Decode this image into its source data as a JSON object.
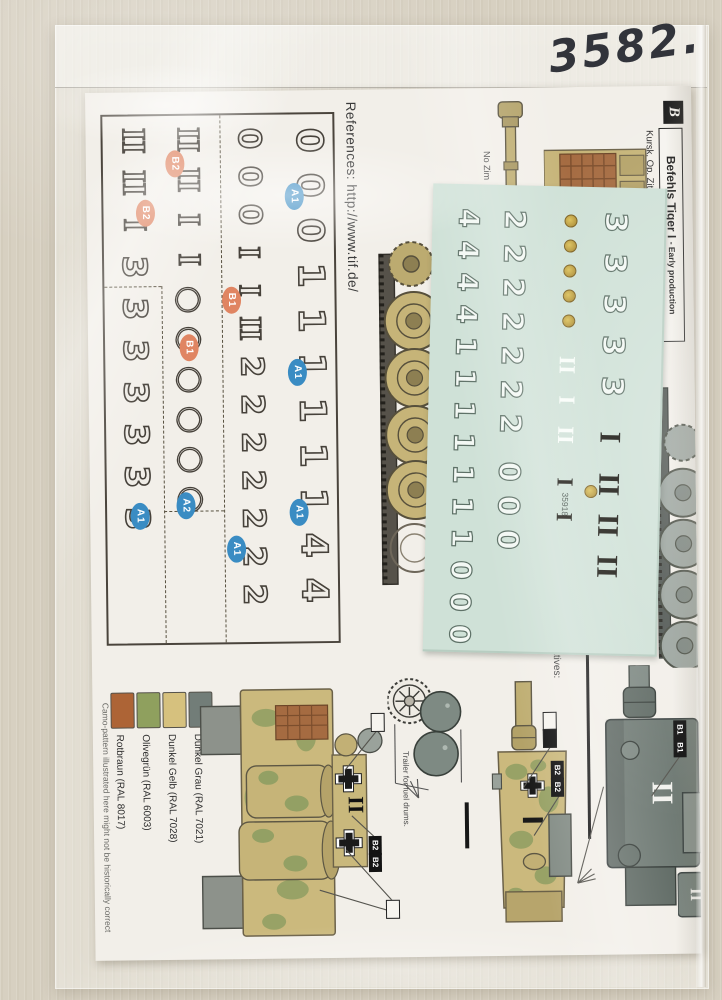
{
  "photo": {
    "handwritten_number": "3582.",
    "surface_color": "#d7d0c1"
  },
  "sheet": {
    "references": "References: http://www.tif.de/",
    "header": {
      "series_letter": "B",
      "title": "Befehls Tiger I ",
      "title_suffix": "- Early production",
      "subtitle": "Kursk, Op. Zitadelle, Summer 1943."
    },
    "notes": {
      "no_zimmerit": "No Zim",
      "alternatives": "alternatives:",
      "trailer_caption": "Trailer for fuel drums.",
      "camo_disclaimer": "Camo-pattern illustrated here might not be historically correct"
    },
    "paint_legend": [
      {
        "label": "Rotbraun (RAL 8017)",
        "hex": "#ad6436"
      },
      {
        "label": "Olivegrün (RAL 6003)",
        "hex": "#8fa05e"
      },
      {
        "label": "Dunkel Gelb (RAL 7028)",
        "hex": "#d6c17e"
      },
      {
        "label": "Dunkel Grau (RAL 7021)",
        "hex": "#727d78"
      }
    ],
    "decal_guide": {
      "label_colors": {
        "a": "#3a8cc3",
        "b": "#e08562"
      },
      "columns": [
        {
          "left": 182,
          "top": 8,
          "size": 36,
          "gap": 9,
          "glyphs": [
            [
              "0",
              "d"
            ],
            [
              "0",
              "d"
            ],
            [
              "0",
              "d"
            ],
            [
              "1",
              "d"
            ],
            [
              "1",
              "d"
            ],
            [
              "1",
              "d"
            ],
            [
              "1",
              "d"
            ],
            [
              "1",
              "d"
            ],
            [
              "1",
              "d"
            ],
            [
              "4",
              "d"
            ],
            [
              "4",
              "d"
            ]
          ]
        },
        {
          "left": 122,
          "top": 8,
          "size": 31,
          "gap": 7,
          "glyphs": [
            [
              "0",
              "d"
            ],
            [
              "0",
              "d"
            ],
            [
              "0",
              "d"
            ],
            [
              "I",
              "r"
            ],
            [
              "I",
              "r"
            ],
            [
              "II",
              "r"
            ],
            [
              "2",
              "d"
            ],
            [
              "2",
              "d"
            ],
            [
              "2",
              "d"
            ],
            [
              "2",
              "d"
            ],
            [
              "2",
              "d"
            ],
            [
              "2",
              "d"
            ],
            [
              "2",
              "d"
            ]
          ]
        },
        {
          "left": 62,
          "top": 8,
          "size": 32,
          "gap": 8,
          "glyphs": [
            [
              "II",
              "r"
            ],
            [
              "II",
              "r"
            ],
            [
              "I",
              "r"
            ],
            [
              "I",
              "r"
            ],
            [
              "○",
              "c"
            ],
            [
              "○",
              "c"
            ],
            [
              "○",
              "c"
            ],
            [
              "○",
              "c"
            ],
            [
              "○",
              "c"
            ],
            [
              "○",
              "c"
            ]
          ]
        },
        {
          "left": 6,
          "top": 8,
          "size": 33,
          "gap": 9,
          "glyphs": [
            [
              "II",
              "r"
            ],
            [
              "II",
              "r"
            ],
            [
              "I",
              "r"
            ],
            [
              "3",
              "d"
            ],
            [
              "3",
              "d"
            ],
            [
              "3",
              "d"
            ],
            [
              "3",
              "d"
            ],
            [
              "3",
              "d"
            ],
            [
              "3",
              "d"
            ],
            [
              "3",
              "d"
            ]
          ]
        }
      ],
      "labels": [
        {
          "t": "A1",
          "c": "a",
          "x": 191,
          "y": 82
        },
        {
          "t": "B2",
          "c": "b",
          "x": 72,
          "y": 48
        },
        {
          "t": "B2",
          "c": "b",
          "x": 42,
          "y": 97
        },
        {
          "t": "B1",
          "c": "b",
          "x": 127,
          "y": 185
        },
        {
          "t": "B1",
          "c": "b",
          "x": 84,
          "y": 232
        },
        {
          "t": "A1",
          "c": "a",
          "x": 192,
          "y": 258
        },
        {
          "t": "A1",
          "c": "a",
          "x": 192,
          "y": 398
        },
        {
          "t": "A2",
          "c": "a",
          "x": 79,
          "y": 390
        },
        {
          "t": "A1",
          "c": "a",
          "x": 33,
          "y": 400
        },
        {
          "t": "A1",
          "c": "a",
          "x": 129,
          "y": 434
        }
      ]
    },
    "marker_boxes": [
      {
        "t": "B2",
        "x": 281,
        "y": 756
      },
      {
        "t": "B2",
        "x": 281,
        "y": 773
      },
      {
        "t": "B2",
        "x": 464,
        "y": 683
      },
      {
        "t": "B2",
        "x": 464,
        "y": 700
      },
      {
        "t": "B1",
        "x": 587,
        "y": 644
      },
      {
        "t": "B1",
        "x": 587,
        "y": 662
      }
    ],
    "aim_boxes": [
      {
        "x": 285,
        "y": 633,
        "f": "w"
      },
      {
        "x": 457,
        "y": 634,
        "f": "w"
      },
      {
        "x": 457,
        "y": 651,
        "f": "b"
      },
      {
        "x": 298,
        "y": 820,
        "f": "w"
      }
    ]
  },
  "decal_sheet": {
    "code": "35918",
    "backing_color": "#cfe1d7",
    "columns": [
      {
        "left": 16,
        "top": 20,
        "size": 28,
        "gap": 4,
        "glyphs": [
          [
            "4",
            "w"
          ],
          [
            "4",
            "w"
          ],
          [
            "4",
            "w"
          ],
          [
            "4",
            "w"
          ],
          [
            "1",
            "w"
          ],
          [
            "1",
            "w"
          ],
          [
            "1",
            "w"
          ],
          [
            "1",
            "w"
          ],
          [
            "1",
            "w"
          ],
          [
            "1",
            "w"
          ],
          [
            "1",
            "w"
          ],
          [
            "0",
            "w"
          ],
          [
            "0",
            "w"
          ],
          [
            "0",
            "w"
          ]
        ]
      },
      {
        "left": 62,
        "top": 20,
        "size": 29,
        "gap": 5,
        "glyphs": [
          [
            "2",
            "w"
          ],
          [
            "2",
            "w"
          ],
          [
            "2",
            "w"
          ],
          [
            "2",
            "w"
          ],
          [
            "2",
            "w"
          ],
          [
            "2",
            "w"
          ],
          [
            "2",
            "w"
          ],
          [
            "0",
            "w",
            14
          ],
          [
            "0",
            "w"
          ],
          [
            "0",
            "w"
          ]
        ]
      },
      {
        "left": 118,
        "top": 28,
        "size": 23,
        "gap": 12,
        "glyphs": [
          [
            "",
            "e"
          ],
          [
            "",
            "e"
          ],
          [
            "",
            "e"
          ],
          [
            "",
            "e"
          ],
          [
            "",
            "e"
          ],
          [
            "II",
            "W",
            14
          ],
          [
            "I",
            "W"
          ],
          [
            "II",
            "W"
          ],
          [
            "I",
            "b",
            12
          ],
          [
            "I",
            "b"
          ]
        ]
      },
      {
        "left": 162,
        "top": 20,
        "size": 30,
        "gap": 11,
        "glyphs": [
          [
            "3",
            "w"
          ],
          [
            "3",
            "w"
          ],
          [
            "3",
            "w"
          ],
          [
            "3",
            "w"
          ],
          [
            "3",
            "w"
          ],
          [
            "I",
            "b",
            10
          ],
          [
            "II",
            "b",
            6
          ],
          [
            "II",
            "b"
          ],
          [
            "II",
            "b"
          ]
        ]
      }
    ]
  }
}
